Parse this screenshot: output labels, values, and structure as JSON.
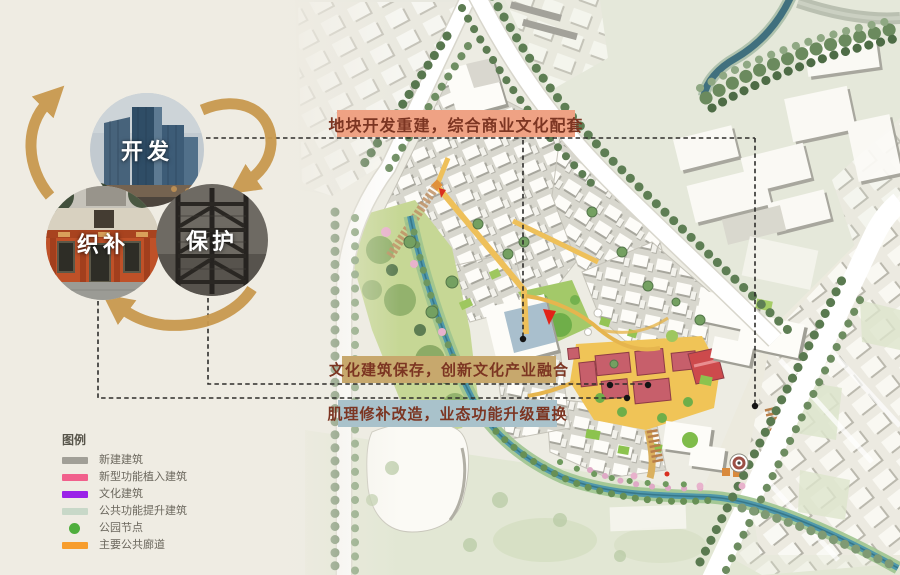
{
  "cycle": {
    "arrow_color": "#c9994f",
    "nodes": [
      {
        "id": "develop",
        "label": "开发",
        "photo": "highrise-towers-photo"
      },
      {
        "id": "mend",
        "label": "织补",
        "photo": "old-storefront-photo"
      },
      {
        "id": "protect",
        "label": "保护",
        "photo": "fire-escape-stairs-photo"
      }
    ]
  },
  "annotations": {
    "text_color": "#7c3522",
    "top": {
      "text": "地块开发重建，综合商业文化配套",
      "bg": "#efa284"
    },
    "middle": {
      "text": "文化建筑保存，创新文化产业融合",
      "bg": "#c7a86d"
    },
    "bottom": {
      "text": "肌理修补改造，业态功能升级置换",
      "bg": "#a9c2cb"
    }
  },
  "legend": {
    "title": "图例",
    "items": [
      {
        "label": "新建建筑",
        "color": "#a19f97",
        "shape": "bar"
      },
      {
        "label": "新型功能植入建筑",
        "color": "#f1608c",
        "shape": "bar"
      },
      {
        "label": "文化建筑",
        "color": "#9a22e8",
        "shape": "bar"
      },
      {
        "label": "公共功能提升建筑",
        "color": "#c8d8c8",
        "shape": "bar"
      },
      {
        "label": "公园节点",
        "color": "#4fae3d",
        "shape": "dot"
      },
      {
        "label": "主要公共廊道",
        "color": "#f79d2d",
        "shape": "bar"
      }
    ]
  },
  "map": {
    "canal_color": "#4f98ab",
    "plaza_color": "#f0c457",
    "cultural_cluster_color": "#c75f6b",
    "corridor_color": "#eec05a"
  }
}
